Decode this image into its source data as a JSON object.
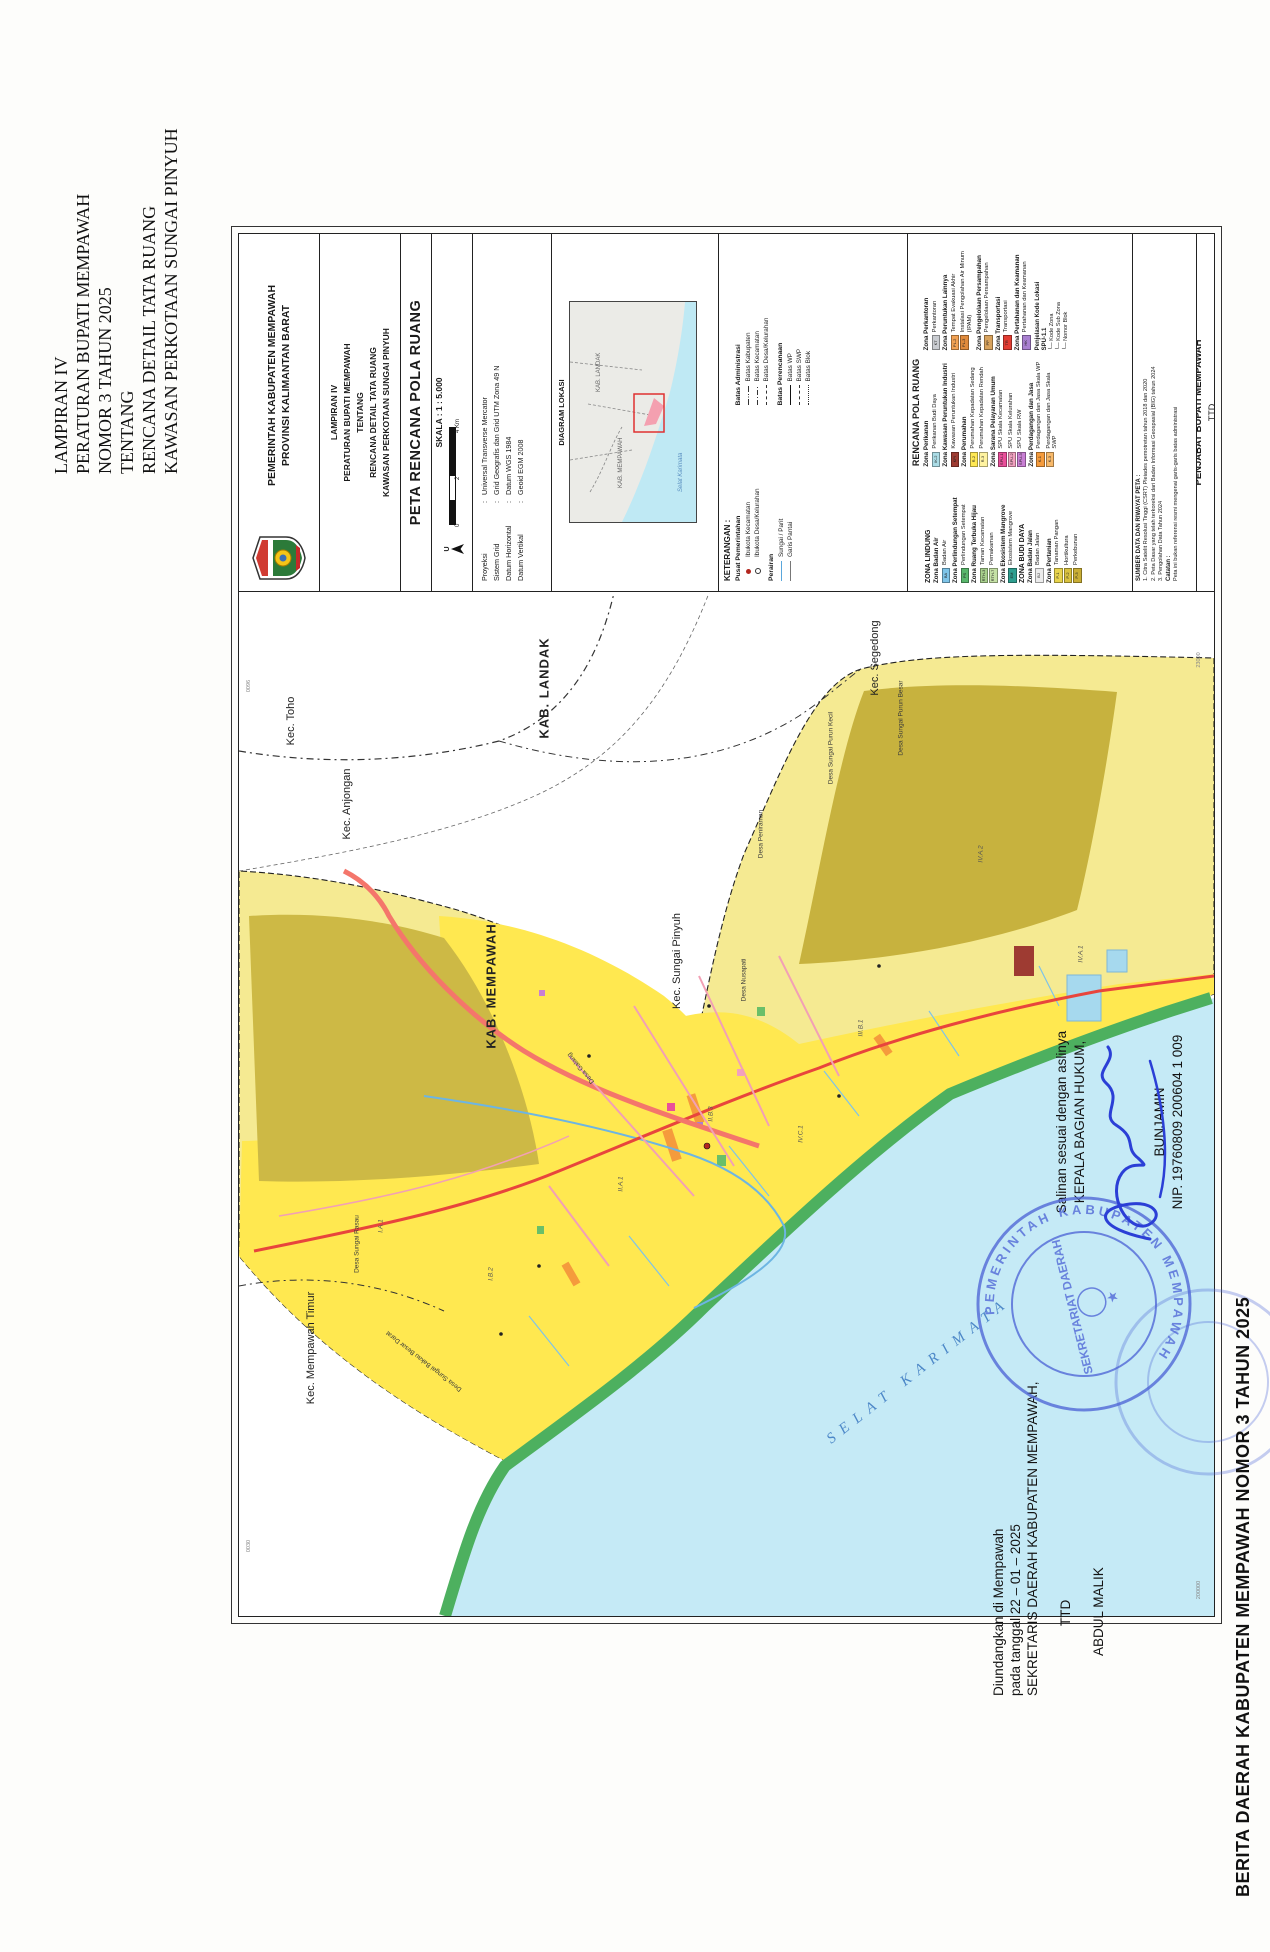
{
  "document": {
    "lampiran_lines": [
      "LAMPIRAN IV",
      "PERATURAN BUPATI MEMPAWAH",
      "NOMOR 3 TAHUN 2025",
      "TENTANG",
      "RENCANA DETAIL TATA RUANG",
      "KAWASAN PERKOTAAN SUNGAI PINYUH"
    ],
    "diundangkan_lines": [
      "Diundangkan di Mempawah",
      "pada tanggal 22 – 01 – 2025",
      "SEKRETARIS DAERAH KABUPATEN MEMPAWAH,",
      "TTD",
      "ABDUL MALIK"
    ],
    "salinan_lines": [
      "Salinan sesuai dengan aslinya",
      "KEPALA BAGIAN HUKUM,",
      "BUNJAMIN",
      "NIP. 19760809 200604 1 009"
    ],
    "berita_footer": "BERITA DAERAH KABUPATEN MEMPAWAH NOMOR 3 TAHUN 2025",
    "stamp": {
      "ring_text": "PEMERINTAH KABUPATEN MEMPAWAH",
      "inner_text": "SEKRETARIAT DAERAH",
      "star": "★"
    }
  },
  "titleblock": {
    "government_lines": [
      "PEMERINTAH KABUPATEN MEMPAWAH",
      "PROVINSI KALIMANTAN BARAT"
    ],
    "lampiran_lines": [
      "LAMPIRAN IV",
      "PERATURAN BUPATI MEMPAWAH",
      "TENTANG",
      "RENCANA DETAIL TATA RUANG",
      "KAWASAN PERKOTAAN SUNGAI PINYUH"
    ],
    "map_title": "PETA RENCANA POLA RUANG",
    "scale": {
      "label": "SKALA : 1 : 5.000",
      "north": "U",
      "ticks": [
        "0",
        "2",
        "4 Km"
      ]
    },
    "projection_rows": [
      {
        "label": "Proyeksi",
        "value": "Universal Transverse Mercator"
      },
      {
        "label": "Sistem Grid",
        "value": "Grid Geografis dan Grid UTM Zona 49 N"
      },
      {
        "label": "Datum Horizontal",
        "value": "Datum WGS 1984"
      },
      {
        "label": "Datum Vertikal",
        "value": "Geoid EGM 2008"
      }
    ],
    "diagram_title": "DIAGRAM LOKASI",
    "inset_labels": {
      "kab1": "KAB. LANDAK",
      "kab2": "KAB. MEMPAWAH",
      "sea": "Selat Karimata"
    },
    "keterangan": {
      "title": "KETERANGAN :",
      "columns": [
        [
          {
            "title": "Pusat Pemerintahan",
            "items": [
              {
                "sym": "dot-filled",
                "label": "Ibukota Kecamatan"
              },
              {
                "sym": "dot-open",
                "label": "Ibukota Desa/Kelurahan"
              }
            ]
          },
          {
            "title": "Perairan",
            "items": [
              {
                "sym": "line-blue",
                "label": "Sungai / Parit"
              },
              {
                "sym": "line-thin",
                "label": "Garis Pantai"
              }
            ]
          }
        ],
        [
          {
            "title": "Batas Administrasi",
            "items": [
              {
                "sym": "dashdotdot",
                "label": "Batas Kabupaten"
              },
              {
                "sym": "dashdot",
                "label": "Batas Kecamatan"
              },
              {
                "sym": "dash",
                "label": "Batas Desa/Kelurahan"
              }
            ]
          },
          {
            "title": "Batas Perencanaan",
            "items": [
              {
                "sym": "solid",
                "label": "Batas WP"
              },
              {
                "sym": "dash",
                "label": "Batas SWP"
              },
              {
                "sym": "dots",
                "label": "Batas Blok"
              }
            ]
          }
        ]
      ]
    },
    "legend": {
      "title": "RENCANA POLA RUANG",
      "columns": [
        [
          {
            "type": "section",
            "title": "ZONA LINDUNG"
          },
          {
            "type": "group",
            "title": "Zona Badan Air",
            "items": [
              {
                "code": "BA",
                "color": "#7ec4e8",
                "label": "Badan Air"
              }
            ]
          },
          {
            "type": "group",
            "title": "Zona Perlindungan Setempat",
            "items": [
              {
                "code": "PS",
                "color": "#58b66b",
                "label": "Perlindungan Setempat"
              }
            ]
          },
          {
            "type": "group",
            "title": "Zona Ruang Terbuka Hijau",
            "items": [
              {
                "code": "RTH-3",
                "color": "#a8d08d",
                "label": "Taman Kecamatan"
              },
              {
                "code": "RTH-7",
                "color": "#c5e1a5",
                "label": "Pemakaman"
              }
            ]
          },
          {
            "type": "group",
            "title": "Zona Ekosistem Mangrove",
            "items": [
              {
                "code": "EM",
                "color": "#2e9e8f",
                "label": "Ekosistem Mangrove"
              }
            ]
          },
          {
            "type": "section",
            "title": "ZONA BUDI DAYA"
          },
          {
            "type": "group",
            "title": "Zona Badan Jalan",
            "items": [
              {
                "code": "BJ",
                "color": "#ececec",
                "label": "Badan Jalan"
              }
            ]
          },
          {
            "type": "group",
            "title": "Zona Pertanian",
            "items": [
              {
                "code": "P-1",
                "color": "#e8d44d",
                "label": "Tanaman Pangan"
              },
              {
                "code": "P-2",
                "color": "#d9c23f",
                "label": "Hortikultura"
              },
              {
                "code": "P-3",
                "color": "#c9ae35",
                "label": "Perkebunan"
              }
            ]
          }
        ],
        [
          {
            "type": "group",
            "title": "Zona Perikanan",
            "items": [
              {
                "code": "IK-2",
                "color": "#aadce6",
                "label": "Perikanan Budi Daya"
              }
            ]
          },
          {
            "type": "group",
            "title": "Zona Kawasan Peruntukan Industri",
            "items": [
              {
                "code": "KPI",
                "color": "#9e3b32",
                "label": "Kawasan Peruntukan Industri"
              }
            ]
          },
          {
            "type": "group",
            "title": "Zona Perumahan",
            "items": [
              {
                "code": "R-2",
                "color": "#ffe852",
                "label": "Perumahan Kepadatan Sedang"
              },
              {
                "code": "R-3",
                "color": "#fff3a0",
                "label": "Perumahan Kepadatan Rendah"
              }
            ]
          },
          {
            "type": "group",
            "title": "Zona Sarana Pelayanan Umum",
            "items": [
              {
                "code": "SPU-1",
                "color": "#e94f9a",
                "label": "SPU Skala Kecamatan"
              },
              {
                "code": "SPU-2",
                "color": "#f2a0c0",
                "label": "SPU Skala Kelurahan"
              },
              {
                "code": "SPU-3",
                "color": "#c97fd4",
                "label": "SPU Skala RW"
              }
            ]
          },
          {
            "type": "group",
            "title": "Zona Perdagangan dan Jasa",
            "items": [
              {
                "code": "K-1",
                "color": "#f59b3c",
                "label": "Perdagangan dan Jasa Skala WP"
              },
              {
                "code": "K-3",
                "color": "#f8b96a",
                "label": "Perdagangan dan Jasa Skala SWP"
              }
            ]
          }
        ],
        [
          {
            "type": "group",
            "title": "Zona Perkantoran",
            "items": [
              {
                "code": "KT",
                "color": "#c9ccd1",
                "label": "Perkantoran"
              }
            ]
          },
          {
            "type": "group",
            "title": "Zona Peruntukan Lainnya",
            "items": [
              {
                "code": "PL-2",
                "color": "#f2a254",
                "label": "Tempat Evakuasi Akhir"
              },
              {
                "code": "PL-3",
                "color": "#e08a3c",
                "label": "Instalasi Pengolahan Air Minum (IPAM)"
              }
            ]
          },
          {
            "type": "group",
            "title": "Zona Pengelolaan Persampahan",
            "items": [
              {
                "code": "PP",
                "color": "#d8a35e",
                "label": "Pengelolaan Persampahan"
              }
            ]
          },
          {
            "type": "group",
            "title": "Zona Transportasi",
            "items": [
              {
                "code": "TR",
                "color": "#e23c32",
                "label": "Transportasi"
              }
            ]
          },
          {
            "type": "group",
            "title": "Zona Pertahanan dan Keamanan",
            "items": [
              {
                "code": "HK",
                "color": "#a87fd0",
                "label": "Pertahanan dan Keamanan"
              }
            ]
          },
          {
            "type": "note",
            "title": "Penjelasan Kode Lokasi",
            "code": "SPU-1.1",
            "pointers": [
              "Kode Zona",
              "Kode Sub Zona",
              "Nomor Blok"
            ]
          }
        ]
      ]
    },
    "sumber": {
      "title": "SUMBER DATA DAN RIWAYAT PETA :",
      "items": [
        "1. Citra Satelit Resolusi Tinggi (CSRT) Pleiades pemotretan tahun 2018 dan 2020",
        "2. Peta Dasar yang telah terkoreksi dari Badan Informasi Geospasial (BIG) tahun 2024",
        "3. Pengolahan Data Tahun 2024"
      ],
      "note_title": "Catatan :",
      "note": "Peta ini bukan referensi resmi mengenai garis-garis batas administrasi"
    },
    "approval_lines": [
      "Mengetahui,",
      "PENJABAT BUPATI MEMPAWAH",
      "TTD",
      "ISMAIL"
    ]
  },
  "map": {
    "sea_label": "SELAT KARIMATA",
    "labels": [
      {
        "t": "Kec. Toho",
        "x": 895,
        "y": 52,
        "c": "kec",
        "r": 0
      },
      {
        "t": "Kec. Anjongan",
        "x": 812,
        "y": 108,
        "c": "kec",
        "r": 0
      },
      {
        "t": "KAB. LANDAK",
        "x": 928,
        "y": 305,
        "c": "kab",
        "r": 0
      },
      {
        "t": "Kec. Segedong",
        "x": 958,
        "y": 636,
        "c": "kec",
        "r": 0
      },
      {
        "t": "KAB. MEMPAWAH",
        "x": 630,
        "y": 252,
        "c": "kab",
        "r": 0
      },
      {
        "t": "Kec. Sungai Pinyuh",
        "x": 655,
        "y": 438,
        "c": "kec",
        "r": 0
      },
      {
        "t": "Kec. Mempawah Timur",
        "x": 268,
        "y": 72,
        "c": "kec",
        "r": 0
      },
      {
        "t": "Desa Sungai Bakau Besar Darat",
        "x": 255,
        "y": 185,
        "c": "desa",
        "r": -52
      },
      {
        "t": "Desa Sungai Rasau",
        "x": 372,
        "y": 118,
        "c": "desa",
        "r": 0
      },
      {
        "t": "Desa Galang",
        "x": 548,
        "y": 342,
        "c": "desa",
        "r": -40
      },
      {
        "t": "Desa Nusapati",
        "x": 636,
        "y": 505,
        "c": "desa",
        "r": 0
      },
      {
        "t": "Desa Peniraman",
        "x": 782,
        "y": 522,
        "c": "desa",
        "r": 0
      },
      {
        "t": "Desa Sungai Purun Kecil",
        "x": 868,
        "y": 592,
        "c": "desa",
        "r": 0
      },
      {
        "t": "Desa Sungai Purun Besar",
        "x": 898,
        "y": 662,
        "c": "desa",
        "r": 0
      },
      {
        "t": "I.A.1",
        "x": 390,
        "y": 142,
        "c": "code",
        "r": 0
      },
      {
        "t": "I.B.2",
        "x": 342,
        "y": 252,
        "c": "code",
        "r": 0
      },
      {
        "t": "II.A.1",
        "x": 432,
        "y": 382,
        "c": "code",
        "r": 0
      },
      {
        "t": "II.B.3",
        "x": 502,
        "y": 472,
        "c": "code",
        "r": 0
      },
      {
        "t": "IV.C.1",
        "x": 482,
        "y": 562,
        "c": "code",
        "r": 0
      },
      {
        "t": "III.B.1",
        "x": 588,
        "y": 622,
        "c": "code",
        "r": 0
      },
      {
        "t": "IV.A.2",
        "x": 762,
        "y": 742,
        "c": "code",
        "r": 0
      },
      {
        "t": "IV.A.1",
        "x": 662,
        "y": 842,
        "c": "code",
        "r": 0
      }
    ],
    "grid_labels": [
      {
        "t": "0030",
        "x": 70,
        "y": 10
      },
      {
        "t": "0096",
        "x": 930,
        "y": 10
      },
      {
        "t": "200000",
        "x": 26,
        "y": 960
      },
      {
        "t": "23000",
        "x": 956,
        "y": 960
      }
    ],
    "colors": {
      "sea": "#c5eaf6",
      "coast_green": "#4db05f",
      "residential_yellow": "#ffe850",
      "agri_olive": "#cdb945",
      "base_pale": "#f5ea92",
      "road_red": "#e8453c",
      "highway_salmon": "#f4766b",
      "stamp_blue": "#4f66d6",
      "signature_blue": "#2b3fd6"
    }
  }
}
